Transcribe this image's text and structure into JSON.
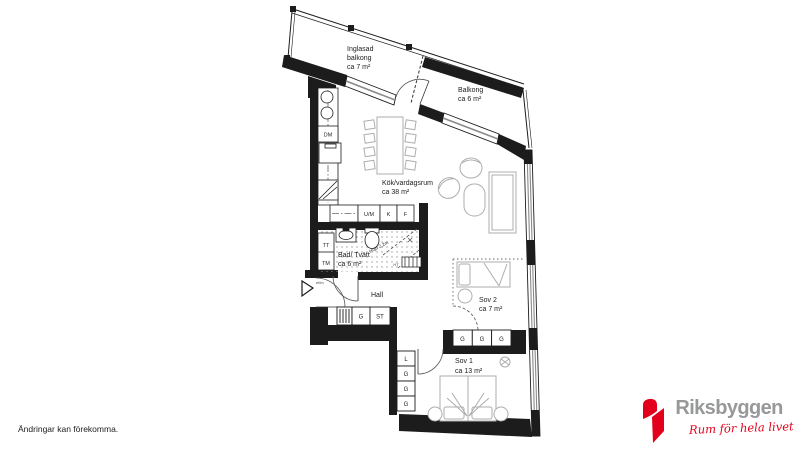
{
  "plan": {
    "rooms": {
      "inglasad_balkong": {
        "name_line1": "Inglasad",
        "name_line2": "balkong",
        "area": "ca 7 m²"
      },
      "balkong": {
        "name": "Balkong",
        "area": "ca 6 m²"
      },
      "kok_vardagsrum": {
        "name": "Kök/vardagsrum",
        "area": "ca 38 m²"
      },
      "bad_tvatt": {
        "name": "Bad/ Tvätt",
        "area": "ca 6 m²"
      },
      "hall": {
        "name": "Hall"
      },
      "sov2": {
        "name": "Sov 2",
        "area": "ca 7 m²"
      },
      "sov1": {
        "name": "Sov 1",
        "area": "ca 13 m²"
      }
    },
    "appliances": {
      "dishwasher": "DM",
      "oven_microwave": "U/M",
      "fridge": "K",
      "freezer": "F",
      "dryer": "TT",
      "washer": "TM",
      "towel_dryer": "HT"
    },
    "storage": {
      "hall_units": [
        "G",
        "ST"
      ],
      "sov1_units": [
        "L",
        "G",
        "G",
        "G"
      ],
      "sov2_units": [
        "G",
        "G",
        "G"
      ]
    },
    "annotations": {
      "ceiling_height": "Höjd 2,2m",
      "entry_label": "el/m"
    }
  },
  "footer": {
    "disclaimer": "Ändringar kan förekomma."
  },
  "brand": {
    "name": "Riksbyggen",
    "tagline": "Rum för hela livet",
    "logo_red": "#E2001A",
    "text_gray": "#97989A"
  }
}
